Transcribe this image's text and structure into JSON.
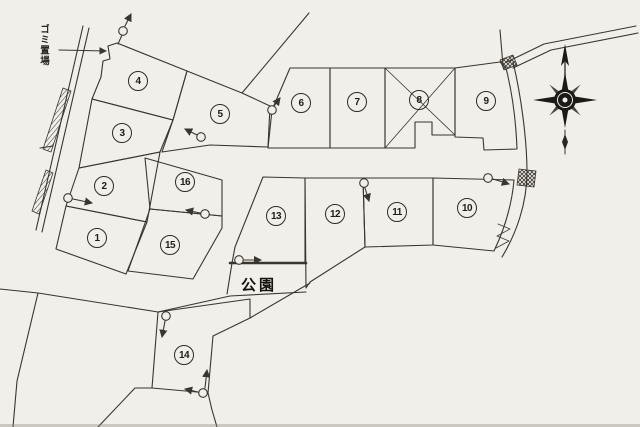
{
  "canvas": {
    "background": "#f1efe9",
    "ink": "#39352f",
    "park_boundary_weight": "thick"
  },
  "labels": {
    "garbage_station": "ゴミ置場",
    "park": "公園"
  },
  "plots": [
    {
      "number": "1"
    },
    {
      "number": "2"
    },
    {
      "number": "3"
    },
    {
      "number": "4"
    },
    {
      "number": "5"
    },
    {
      "number": "6"
    },
    {
      "number": "7"
    },
    {
      "number": "8"
    },
    {
      "number": "9"
    },
    {
      "number": "10"
    },
    {
      "number": "11"
    },
    {
      "number": "12"
    },
    {
      "number": "13"
    },
    {
      "number": "14"
    },
    {
      "number": "15"
    },
    {
      "number": "16"
    }
  ],
  "symbols": {
    "compass": "compass-rose",
    "utility_markers": "circle-with-arrow",
    "crossing_marks": "crosshatch-box",
    "slope_marks": "zigzag",
    "plot8_mark": "x-cross"
  }
}
